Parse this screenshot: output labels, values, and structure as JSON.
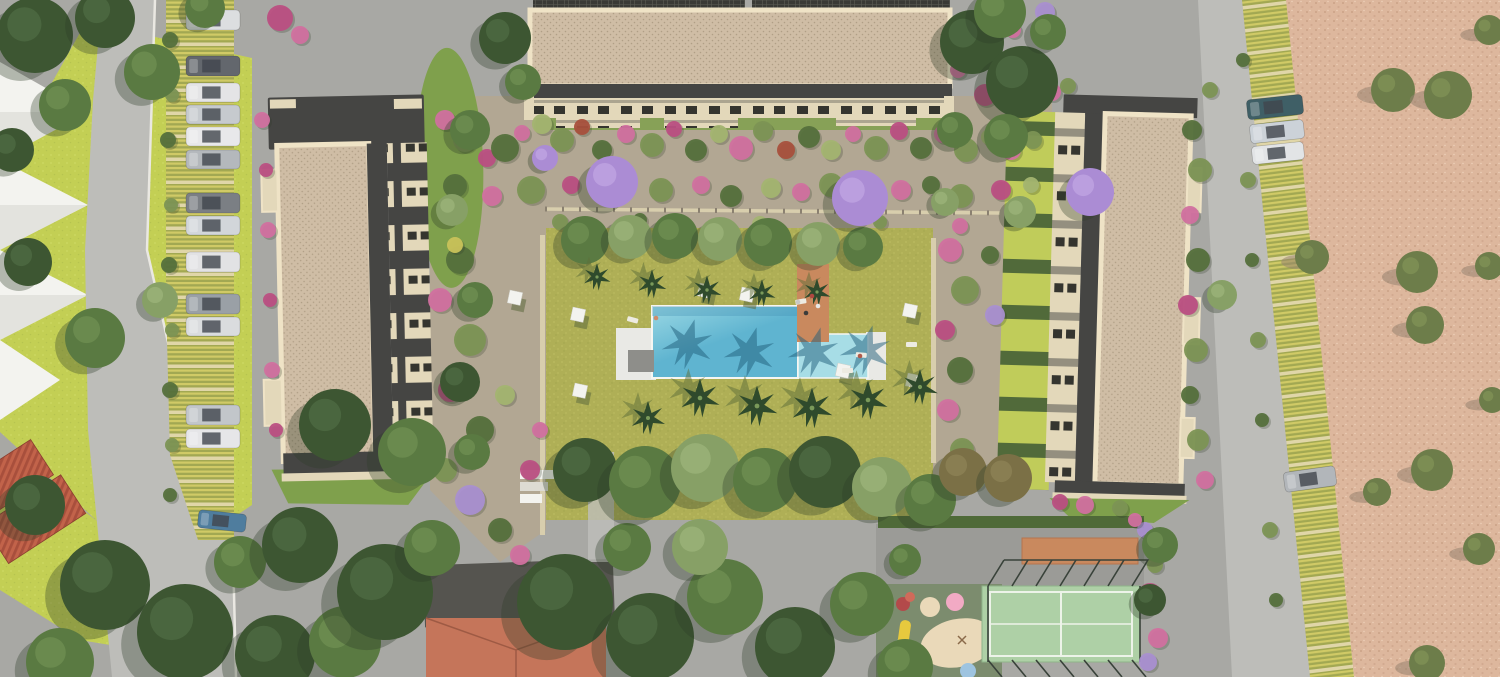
{
  "meta": {
    "type": "architectural-aerial-render",
    "subject": "residential-complex-site-plan",
    "width": 1500,
    "height": 677
  },
  "palette": {
    "pavement": "#a8a8a4",
    "road": "#bdbdb9",
    "plaza": "#a0a09c",
    "curb": "#eae8e2",
    "lawnBright": "#c3cf54",
    "lawnOlive": "#afaf56",
    "lawnDot": "#c2c266",
    "tan": "#b2a793",
    "sand": "#ddb79d",
    "sandDot": "#c69c82",
    "wall": "#d8cead",
    "fencePost": "#8a8070",
    "white": "#f3f3ef",
    "deck": "#e9e9e5",
    "mat": "#8e8e8a",
    "poolLight": "#9ad8e4",
    "poolMid": "#5fb4d0",
    "poolDark": "#3f8cb0",
    "poolRight": "#a7dde6",
    "terracotta": "#c9895e",
    "roofBase": "#cfbda5",
    "roofDot": "#9b8a72",
    "roofBorder": "#efe3c6",
    "roofDark": "#454543",
    "facadeCream": "#e3d8ba",
    "windowDark": "#35352f",
    "hedge": "#4f6a38",
    "mound": "#7fa04c",
    "terraceStripe": "#c0cc5a",
    "terraceHedge": "#516a3a",
    "parkYellow": "#d0ca66",
    "parkGreen": "#a2a852",
    "parkDivider": "#e0d6a8",
    "redRoof1": "#c2634a",
    "redRoof2": "#a84f3c",
    "tileRoof": "#c5755a",
    "tileRidge": "#9e5a44",
    "darkRoof": "#55544f",
    "playGreen": "#7c8c6e",
    "blobBeige": "#ead9b9",
    "courtGreen": "#aed0a6",
    "courtLine": "#edf3e9",
    "fenceDark": "#39423a",
    "treeShadow": "#2e3c26",
    "grayShadow": "#8c8c86",
    "palmFrond": "#2f4a2c",
    "palmShadow": "#5e6e38",
    "palmPool": "#1f5e7a",
    "palmCenter": "#7a9a5a",
    "sandOlive": "#6d7d4a",
    "umbShadow": "#5c6a3e"
  },
  "scene": {
    "labels": [
      "left-lawn-zone",
      "access-road",
      "left-parking-row",
      "left-apartment-building",
      "top-apartment-building",
      "right-apartment-building",
      "central-garden",
      "swimming-pool",
      "pool-deck",
      "terracotta-path",
      "tree-plaza",
      "red-tile-roof-building",
      "playground",
      "padel-court",
      "right-parking-row",
      "sand-field"
    ],
    "treeTones": {
      "dark": [
        "#3d5632",
        "#55744a"
      ],
      "mid": [
        "#5a7a42",
        "#78985a"
      ],
      "sage": [
        "#87a066",
        "#a4bc82"
      ],
      "light": [
        "#9ab478",
        "#b8d096"
      ],
      "brown": [
        "#7b7046",
        "#968a5c"
      ],
      "pur": [
        "#ab8cd4",
        "#c9aee8"
      ]
    },
    "shrubColors": {
      "g1": "#55703c",
      "g2": "#7c9454",
      "g3": "#a3b470",
      "pink": "#d1709f",
      "mag": "#bb4f82",
      "pur": "#a98fd0",
      "red": "#a8503c",
      "wht": "#e8e8e2",
      "yel": "#c9c25a"
    },
    "trees": [
      [
        35,
        35,
        38,
        "dark"
      ],
      [
        105,
        18,
        30,
        "dark"
      ],
      [
        152,
        72,
        28,
        "mid"
      ],
      [
        65,
        105,
        26,
        "mid"
      ],
      [
        12,
        150,
        22,
        "dark"
      ],
      [
        205,
        8,
        20,
        "mid"
      ],
      [
        28,
        262,
        24,
        "dark"
      ],
      [
        95,
        338,
        30,
        "mid"
      ],
      [
        160,
        300,
        18,
        "sage"
      ],
      [
        35,
        505,
        30,
        "dark"
      ],
      [
        105,
        585,
        45,
        "dark"
      ],
      [
        185,
        632,
        48,
        "dark"
      ],
      [
        275,
        655,
        40,
        "dark"
      ],
      [
        345,
        642,
        36,
        "mid"
      ],
      [
        60,
        662,
        34,
        "mid"
      ],
      [
        240,
        562,
        26,
        "mid"
      ],
      [
        300,
        545,
        38,
        "dark"
      ],
      [
        385,
        592,
        48,
        "dark"
      ],
      [
        432,
        548,
        28,
        "mid"
      ],
      [
        335,
        425,
        36,
        "dark"
      ],
      [
        412,
        452,
        34,
        "mid"
      ],
      [
        565,
        602,
        48,
        "dark"
      ],
      [
        650,
        637,
        44,
        "dark"
      ],
      [
        725,
        597,
        38,
        "mid"
      ],
      [
        795,
        647,
        40,
        "dark"
      ],
      [
        862,
        604,
        32,
        "mid"
      ],
      [
        700,
        547,
        28,
        "sage"
      ],
      [
        905,
        667,
        28,
        "mid"
      ],
      [
        627,
        547,
        24,
        "mid"
      ],
      [
        585,
        470,
        32,
        "dark"
      ],
      [
        645,
        482,
        36,
        "mid"
      ],
      [
        705,
        468,
        34,
        "sage"
      ],
      [
        765,
        480,
        32,
        "mid"
      ],
      [
        825,
        472,
        36,
        "dark"
      ],
      [
        882,
        487,
        30,
        "sage"
      ],
      [
        930,
        500,
        26,
        "mid"
      ],
      [
        963,
        472,
        24,
        "brown"
      ],
      [
        1008,
        478,
        24,
        "brown"
      ],
      [
        972,
        42,
        32,
        "dark"
      ],
      [
        1022,
        82,
        36,
        "dark"
      ],
      [
        1000,
        12,
        26,
        "mid"
      ],
      [
        1048,
        32,
        18,
        "mid"
      ],
      [
        505,
        38,
        26,
        "dark"
      ],
      [
        523,
        82,
        18,
        "mid"
      ],
      [
        470,
        130,
        20,
        "mid"
      ],
      [
        452,
        210,
        16,
        "sage"
      ],
      [
        475,
        300,
        18,
        "mid"
      ],
      [
        460,
        382,
        20,
        "dark"
      ],
      [
        472,
        452,
        18,
        "mid"
      ],
      [
        1006,
        136,
        22,
        "mid"
      ],
      [
        1020,
        212,
        16,
        "sage"
      ],
      [
        955,
        130,
        18,
        "mid"
      ],
      [
        945,
        202,
        14,
        "sage"
      ],
      [
        585,
        240,
        24,
        "mid"
      ],
      [
        630,
        237,
        22,
        "sage"
      ],
      [
        675,
        236,
        23,
        "mid"
      ],
      [
        720,
        239,
        22,
        "sage"
      ],
      [
        768,
        242,
        24,
        "mid"
      ],
      [
        818,
        244,
        22,
        "sage"
      ],
      [
        863,
        247,
        20,
        "mid"
      ],
      [
        612,
        182,
        26,
        "pur"
      ],
      [
        860,
        198,
        28,
        "pur"
      ],
      [
        1090,
        192,
        24,
        "pur"
      ],
      [
        545,
        158,
        13,
        "pur"
      ],
      [
        1222,
        295,
        15,
        "sage"
      ],
      [
        1160,
        545,
        18,
        "mid"
      ],
      [
        1150,
        600,
        16,
        "dark"
      ],
      [
        905,
        560,
        16,
        "mid"
      ]
    ],
    "sandTrees": [
      [
        1393,
        90,
        22
      ],
      [
        1448,
        95,
        24
      ],
      [
        1489,
        30,
        15
      ],
      [
        1417,
        272,
        21
      ],
      [
        1489,
        266,
        14
      ],
      [
        1425,
        325,
        19
      ],
      [
        1432,
        470,
        21
      ],
      [
        1479,
        549,
        16
      ],
      [
        1427,
        663,
        18
      ],
      [
        1377,
        492,
        14
      ],
      [
        1312,
        257,
        17
      ],
      [
        1492,
        400,
        13
      ]
    ],
    "palms": [
      [
        597,
        277,
        0.8
      ],
      [
        652,
        284,
        0.85
      ],
      [
        707,
        290,
        0.85
      ],
      [
        762,
        293,
        0.8
      ],
      [
        817,
        292,
        0.8
      ],
      [
        700,
        398,
        1.15
      ],
      [
        757,
        406,
        1.2
      ],
      [
        812,
        408,
        1.2
      ],
      [
        868,
        400,
        1.15
      ],
      [
        920,
        387,
        1.05
      ],
      [
        648,
        418,
        1.0
      ]
    ],
    "poolShadowPalms": [
      [
        688,
        344
      ],
      [
        750,
        352
      ],
      [
        814,
        352
      ],
      [
        866,
        350
      ]
    ],
    "cars": [
      [
        186,
        10,
        54,
        20,
        "#dcdee0",
        0
      ],
      [
        186,
        56,
        54,
        20,
        "#63676d",
        0
      ],
      [
        186,
        83,
        54,
        19,
        "#e4e4e6",
        0
      ],
      [
        186,
        105,
        54,
        19,
        "#c6cace",
        0
      ],
      [
        186,
        127,
        54,
        19,
        "#e8e8ea",
        0
      ],
      [
        186,
        150,
        54,
        19,
        "#b4b8bc",
        0
      ],
      [
        186,
        193,
        54,
        20,
        "#7b7f84",
        0
      ],
      [
        186,
        216,
        54,
        19,
        "#d2d6da",
        0
      ],
      [
        186,
        252,
        54,
        20,
        "#e2e2e4",
        0
      ],
      [
        186,
        294,
        54,
        20,
        "#9aa0a6",
        0
      ],
      [
        186,
        317,
        54,
        19,
        "#dadcde",
        0
      ],
      [
        186,
        405,
        54,
        20,
        "#c2c6ca",
        0
      ],
      [
        186,
        429,
        54,
        19,
        "#e6e6e8",
        0
      ],
      [
        198,
        512,
        48,
        18,
        "#4f7d9e",
        6
      ],
      [
        1247,
        97,
        56,
        20,
        "#3f5f66",
        -6
      ],
      [
        1250,
        122,
        54,
        19,
        "#ccd2d8",
        -6
      ],
      [
        1252,
        144,
        52,
        18,
        "#e2e4e6",
        -6
      ],
      [
        1284,
        469,
        52,
        20,
        "#b2b6ba",
        -8
      ]
    ],
    "umbrellas": [
      [
        510,
        290
      ],
      [
        573,
        307
      ],
      [
        575,
        383
      ],
      [
        700,
        283
      ],
      [
        742,
        287
      ],
      [
        905,
        303
      ],
      [
        908,
        373
      ],
      [
        838,
        363
      ]
    ],
    "loungers": [
      [
        628,
        316,
        15
      ],
      [
        795,
        300,
        -10
      ],
      [
        856,
        352,
        5
      ],
      [
        842,
        368,
        0
      ],
      [
        906,
        342,
        0
      ]
    ],
    "people": [
      [
        812,
        296,
        "#b04840"
      ],
      [
        818,
        306,
        "#e8e8e6"
      ],
      [
        806,
        313,
        "#3c3c3a"
      ],
      [
        656,
        318,
        "#d08a6a"
      ],
      [
        798,
        302,
        "#c8c8c6"
      ],
      [
        860,
        356,
        "#b05a4a"
      ]
    ],
    "shrubs": [
      [
        445,
        120,
        10,
        "pink"
      ],
      [
        465,
        140,
        12,
        "g2"
      ],
      [
        487,
        158,
        9,
        "mag"
      ],
      [
        505,
        148,
        14,
        "g1"
      ],
      [
        522,
        133,
        8,
        "pink"
      ],
      [
        542,
        124,
        10,
        "g3"
      ],
      [
        562,
        140,
        12,
        "g2"
      ],
      [
        582,
        127,
        8,
        "red"
      ],
      [
        602,
        150,
        10,
        "g1"
      ],
      [
        626,
        134,
        9,
        "pink"
      ],
      [
        652,
        145,
        12,
        "g2"
      ],
      [
        674,
        129,
        8,
        "mag"
      ],
      [
        696,
        150,
        11,
        "g1"
      ],
      [
        719,
        134,
        9,
        "g3"
      ],
      [
        741,
        148,
        12,
        "pink"
      ],
      [
        763,
        131,
        10,
        "g2"
      ],
      [
        786,
        150,
        9,
        "red"
      ],
      [
        809,
        137,
        11,
        "g1"
      ],
      [
        831,
        150,
        10,
        "g3"
      ],
      [
        853,
        134,
        8,
        "pink"
      ],
      [
        876,
        148,
        12,
        "g2"
      ],
      [
        899,
        131,
        9,
        "mag"
      ],
      [
        921,
        148,
        11,
        "g1"
      ],
      [
        943,
        134,
        9,
        "pink"
      ],
      [
        966,
        150,
        12,
        "g2"
      ],
      [
        989,
        137,
        8,
        "g3"
      ],
      [
        1011,
        150,
        10,
        "pink"
      ],
      [
        1033,
        140,
        9,
        "g2"
      ],
      [
        455,
        186,
        12,
        "g1"
      ],
      [
        492,
        196,
        10,
        "pink"
      ],
      [
        531,
        190,
        14,
        "g2"
      ],
      [
        571,
        185,
        9,
        "mag"
      ],
      [
        661,
        190,
        12,
        "g2"
      ],
      [
        701,
        185,
        9,
        "pink"
      ],
      [
        731,
        196,
        11,
        "g1"
      ],
      [
        771,
        188,
        10,
        "g3"
      ],
      [
        801,
        192,
        9,
        "pink"
      ],
      [
        831,
        185,
        12,
        "g2"
      ],
      [
        901,
        190,
        10,
        "pink"
      ],
      [
        931,
        185,
        9,
        "g1"
      ],
      [
        961,
        196,
        12,
        "g2"
      ],
      [
        1001,
        190,
        10,
        "mag"
      ],
      [
        1031,
        185,
        8,
        "g3"
      ],
      [
        560,
        222,
        8,
        "g2"
      ],
      [
        640,
        220,
        7,
        "g1"
      ],
      [
        760,
        224,
        8,
        "g3"
      ],
      [
        880,
        222,
        7,
        "g2"
      ],
      [
        960,
        226,
        8,
        "pink"
      ],
      [
        460,
        260,
        14,
        "g1"
      ],
      [
        440,
        300,
        12,
        "pink"
      ],
      [
        470,
        340,
        16,
        "g2"
      ],
      [
        450,
        390,
        12,
        "mag"
      ],
      [
        480,
        430,
        14,
        "g1"
      ],
      [
        445,
        470,
        12,
        "g2"
      ],
      [
        470,
        500,
        15,
        "pur"
      ],
      [
        500,
        530,
        12,
        "g1"
      ],
      [
        520,
        555,
        10,
        "pink"
      ],
      [
        455,
        245,
        8,
        "yel"
      ],
      [
        530,
        470,
        10,
        "mag"
      ],
      [
        540,
        430,
        8,
        "pink"
      ],
      [
        505,
        395,
        10,
        "g3"
      ],
      [
        950,
        250,
        12,
        "pink"
      ],
      [
        965,
        290,
        14,
        "g2"
      ],
      [
        945,
        330,
        10,
        "mag"
      ],
      [
        960,
        370,
        13,
        "g1"
      ],
      [
        948,
        410,
        11,
        "pink"
      ],
      [
        962,
        450,
        12,
        "g2"
      ],
      [
        975,
        480,
        10,
        "g3"
      ],
      [
        990,
        255,
        9,
        "g1"
      ],
      [
        995,
        315,
        10,
        "pur"
      ],
      [
        1192,
        130,
        10,
        "g1"
      ],
      [
        1200,
        170,
        12,
        "g2"
      ],
      [
        1190,
        215,
        9,
        "pink"
      ],
      [
        1198,
        260,
        12,
        "g1"
      ],
      [
        1188,
        305,
        10,
        "mag"
      ],
      [
        1196,
        350,
        12,
        "g2"
      ],
      [
        1190,
        395,
        9,
        "g1"
      ],
      [
        1198,
        440,
        11,
        "g2"
      ],
      [
        1205,
        480,
        9,
        "pink"
      ],
      [
        1210,
        90,
        8,
        "g2"
      ],
      [
        1150,
        595,
        12,
        "mag"
      ],
      [
        1158,
        638,
        10,
        "pink"
      ],
      [
        1148,
        662,
        9,
        "pur"
      ],
      [
        1155,
        565,
        8,
        "g2"
      ],
      [
        170,
        40,
        8,
        "g1"
      ],
      [
        172,
        95,
        7,
        "g2"
      ],
      [
        168,
        140,
        8,
        "g1"
      ],
      [
        171,
        205,
        7,
        "g2"
      ],
      [
        169,
        265,
        8,
        "g1"
      ],
      [
        172,
        330,
        7,
        "g2"
      ],
      [
        170,
        390,
        8,
        "g1"
      ],
      [
        172,
        445,
        7,
        "g2"
      ],
      [
        170,
        495,
        7,
        "g1"
      ],
      [
        1243,
        60,
        7,
        "g1"
      ],
      [
        1248,
        180,
        8,
        "g2"
      ],
      [
        1252,
        260,
        7,
        "g1"
      ],
      [
        1258,
        340,
        8,
        "g2"
      ],
      [
        1262,
        420,
        7,
        "g1"
      ],
      [
        1270,
        530,
        8,
        "g2"
      ],
      [
        1276,
        600,
        7,
        "g1"
      ],
      [
        280,
        18,
        13,
        "mag"
      ],
      [
        300,
        35,
        9,
        "pink"
      ],
      [
        218,
        66,
        8,
        "pink"
      ],
      [
        262,
        120,
        8,
        "pink"
      ],
      [
        266,
        170,
        7,
        "mag"
      ],
      [
        268,
        230,
        8,
        "pink"
      ],
      [
        270,
        300,
        7,
        "mag"
      ],
      [
        272,
        370,
        8,
        "pink"
      ],
      [
        276,
        430,
        7,
        "mag"
      ],
      [
        985,
        95,
        11,
        "mag"
      ],
      [
        1013,
        30,
        8,
        "pink"
      ],
      [
        1045,
        12,
        10,
        "pur"
      ],
      [
        958,
        70,
        8,
        "pink"
      ],
      [
        1052,
        92,
        9,
        "pink"
      ],
      [
        1068,
        86,
        8,
        "g2"
      ],
      [
        1085,
        505,
        9,
        "pink"
      ],
      [
        1120,
        508,
        8,
        "g2"
      ],
      [
        1060,
        502,
        8,
        "mag"
      ],
      [
        1145,
        530,
        8,
        "pur"
      ],
      [
        1135,
        520,
        7,
        "pink"
      ]
    ]
  }
}
